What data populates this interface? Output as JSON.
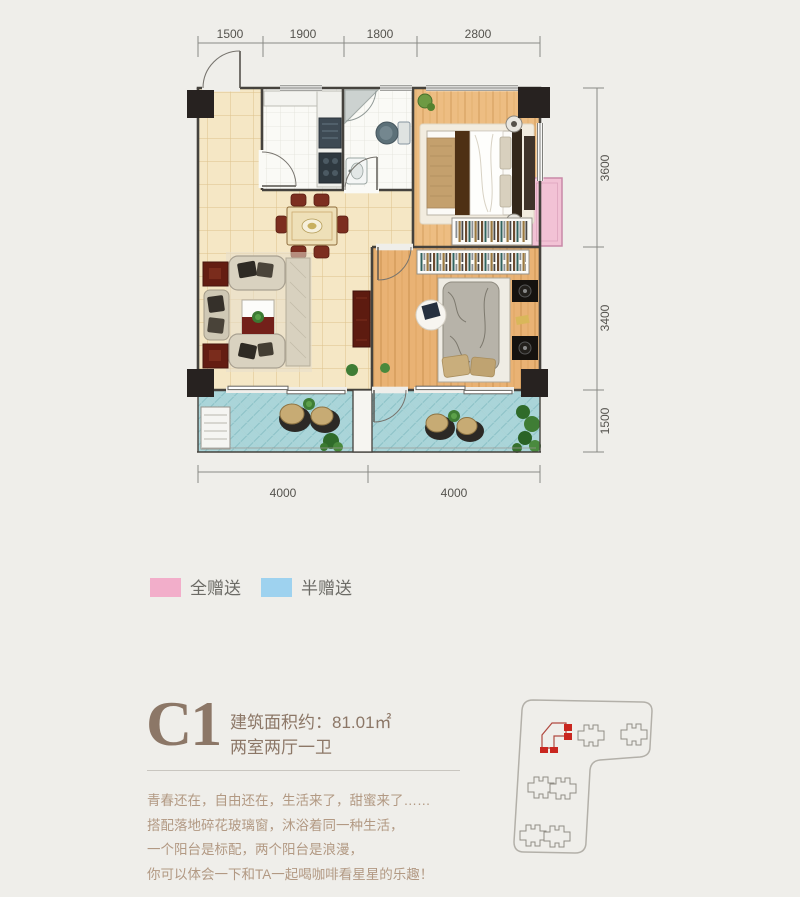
{
  "floor_plan": {
    "dim_top": [
      "1500",
      "1900",
      "1800",
      "2800"
    ],
    "dim_right": [
      "3600",
      "3400",
      "1500"
    ],
    "dim_bottom": [
      "4000",
      "4000"
    ],
    "colors": {
      "wall": "#45423d",
      "cream_tile": "#f5e7c5",
      "wood_floor_bedroom1": "#edbd82",
      "wood_floor_bedroom2": "#e9b274",
      "balcony_tile": "#aad5d9",
      "bay_window_pink": "#f2c2d5"
    }
  },
  "legend": {
    "items": [
      {
        "label": "全赠送",
        "color": "#f2aeca"
      },
      {
        "label": "半赠送",
        "color": "#9ed2ef"
      }
    ]
  },
  "unit": {
    "name": "C1",
    "area": "建筑面积约：81.01㎡",
    "rooms": "两室两厅一卫"
  },
  "description": {
    "lines": [
      "青春还在，自由还在，生活来了，甜蜜来了……",
      "搭配落地碎花玻璃窗，沐浴着同一种生活，",
      "一个阳台是标配，两个阳台是浪漫，",
      "你可以体会一下和TA一起喝咖啡看星星的乐趣！"
    ]
  },
  "siteplan": {
    "highlight_color": "#c9261f",
    "outline_color": "#908d85"
  }
}
